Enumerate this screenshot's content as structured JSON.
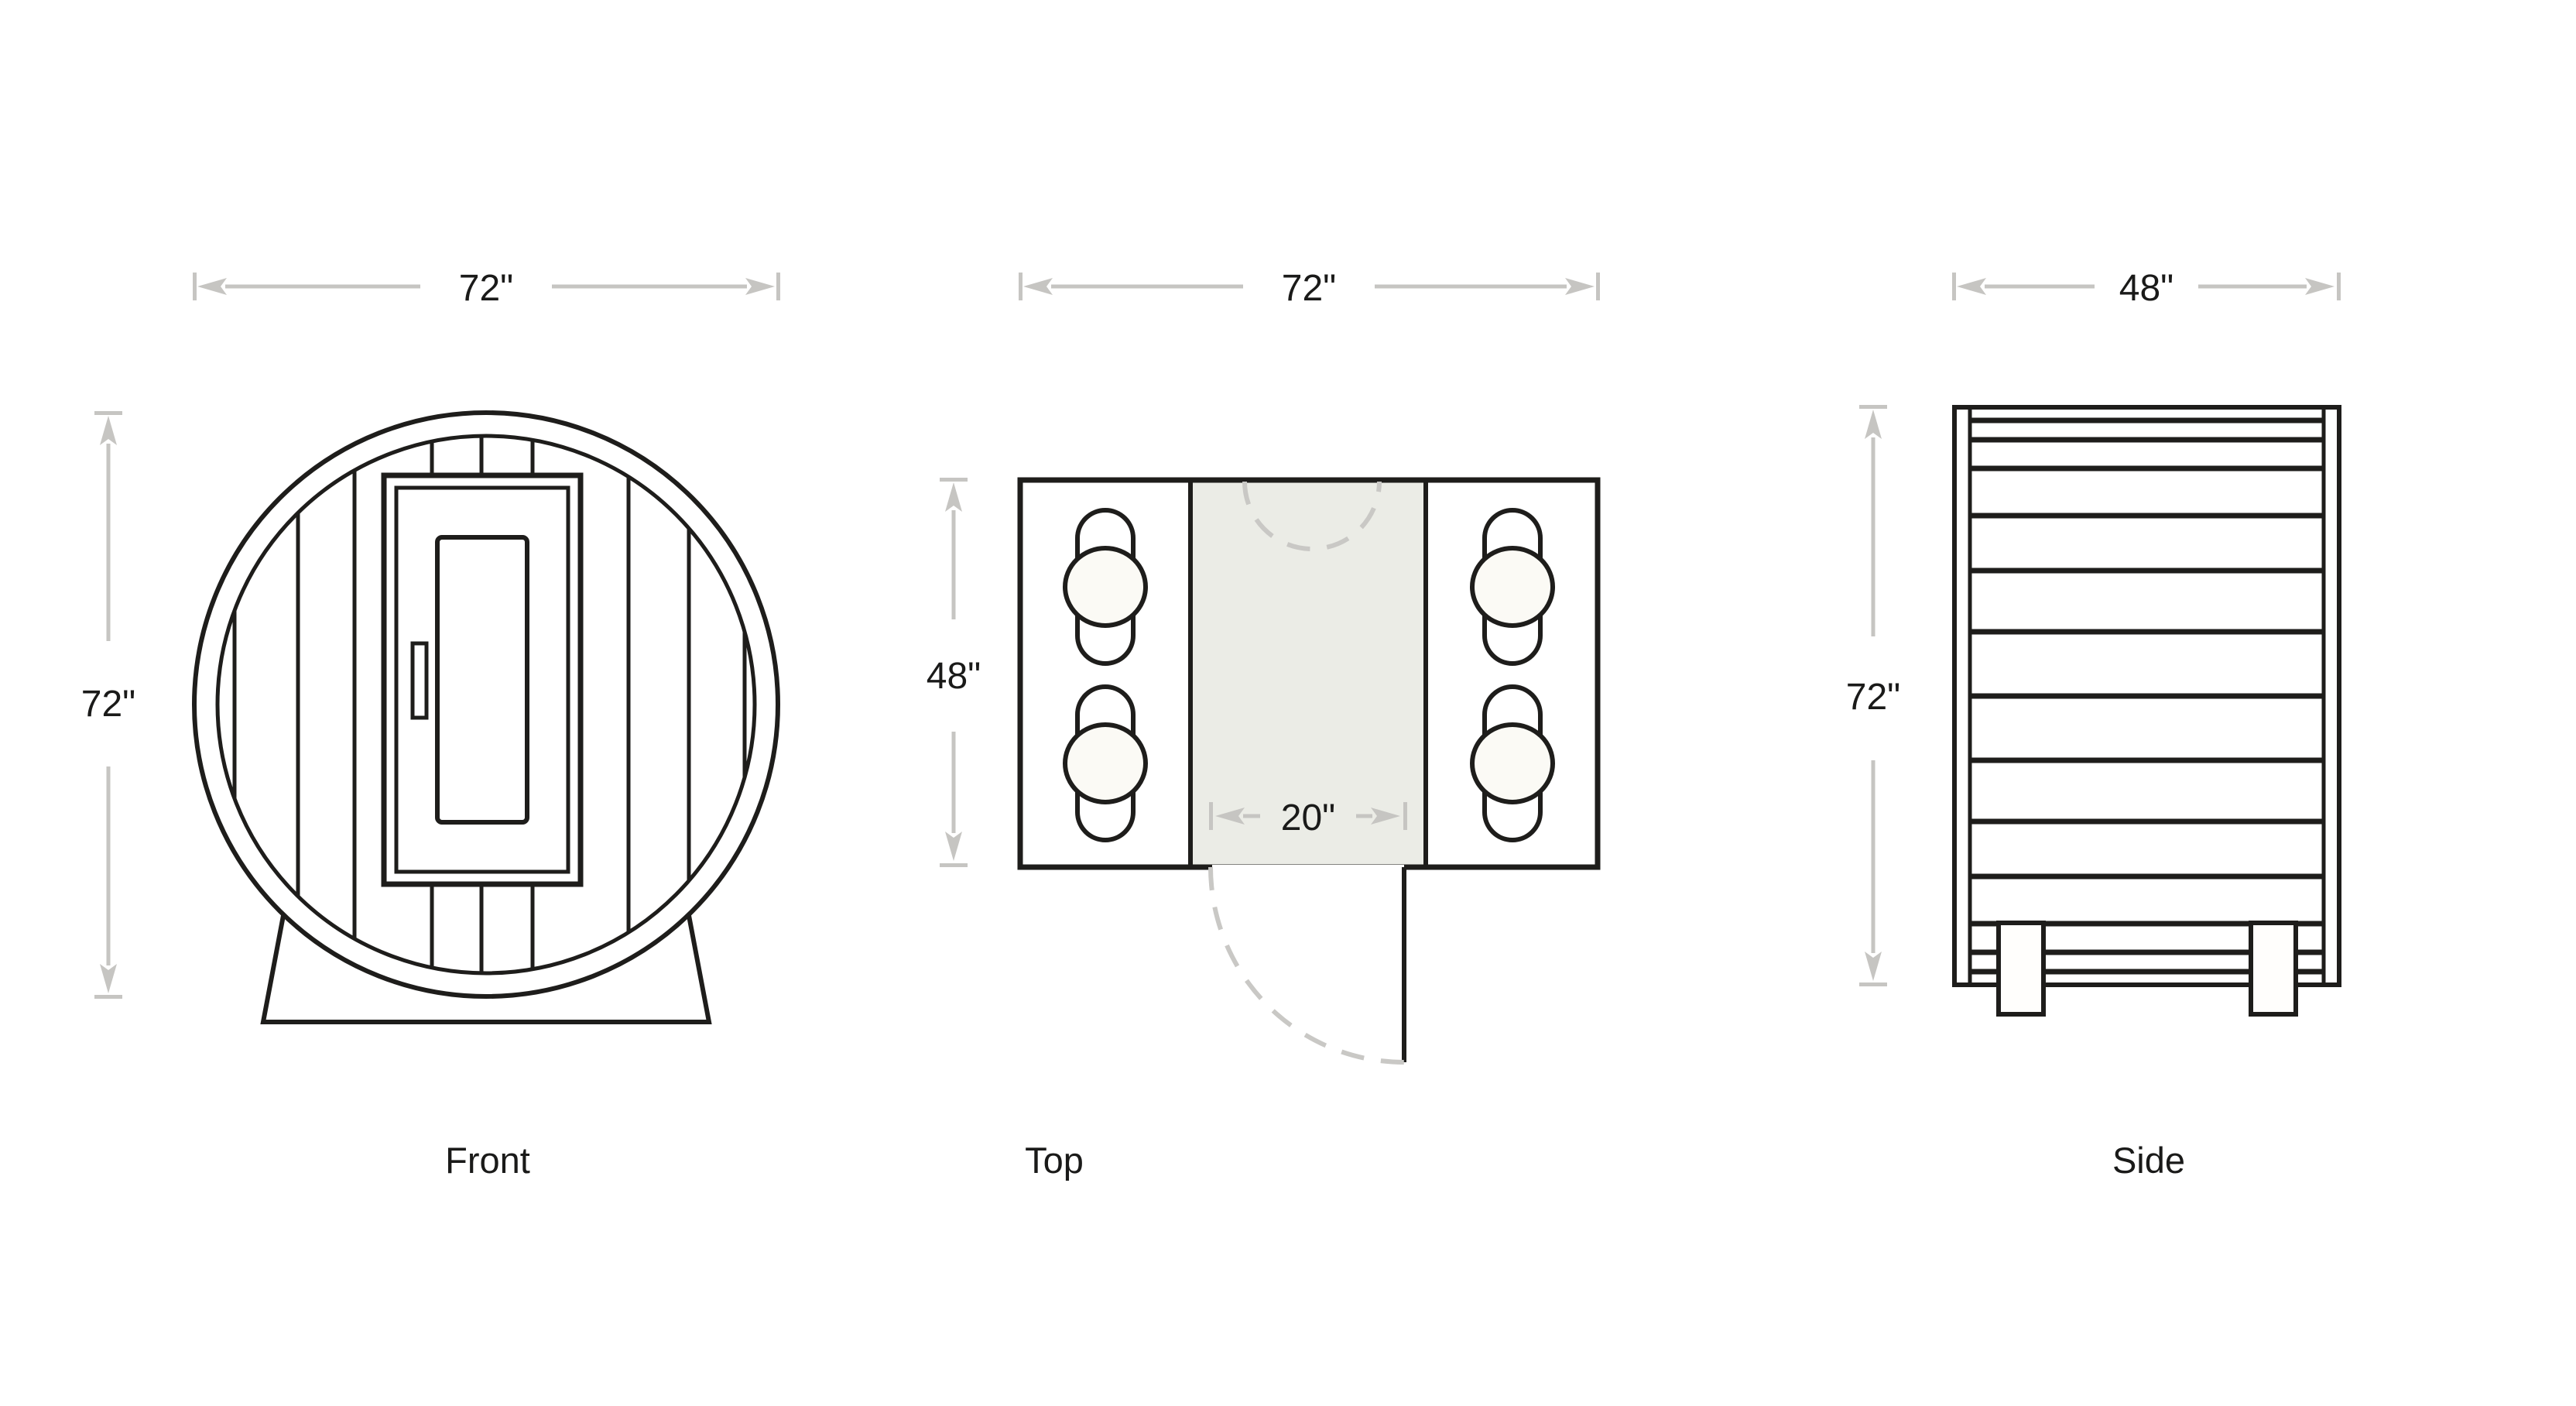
{
  "diagram": {
    "front": {
      "label": "Front",
      "width_dim": "72\"",
      "height_dim": "72\""
    },
    "top": {
      "label": "Top",
      "width_dim": "72\"",
      "height_dim": "48\"",
      "door_dim": "20\""
    },
    "side": {
      "label": "Side",
      "width_dim": "48\"",
      "height_dim": "72\""
    }
  },
  "colors": {
    "line": "#1e1d1b",
    "dim_line": "#c6c5c2",
    "dashed_line": "#c9c8c5",
    "aisle_fill": "#ebece6",
    "person_fill": "#fbfaf5",
    "text": "#1a1a19",
    "background": "#ffffff"
  }
}
